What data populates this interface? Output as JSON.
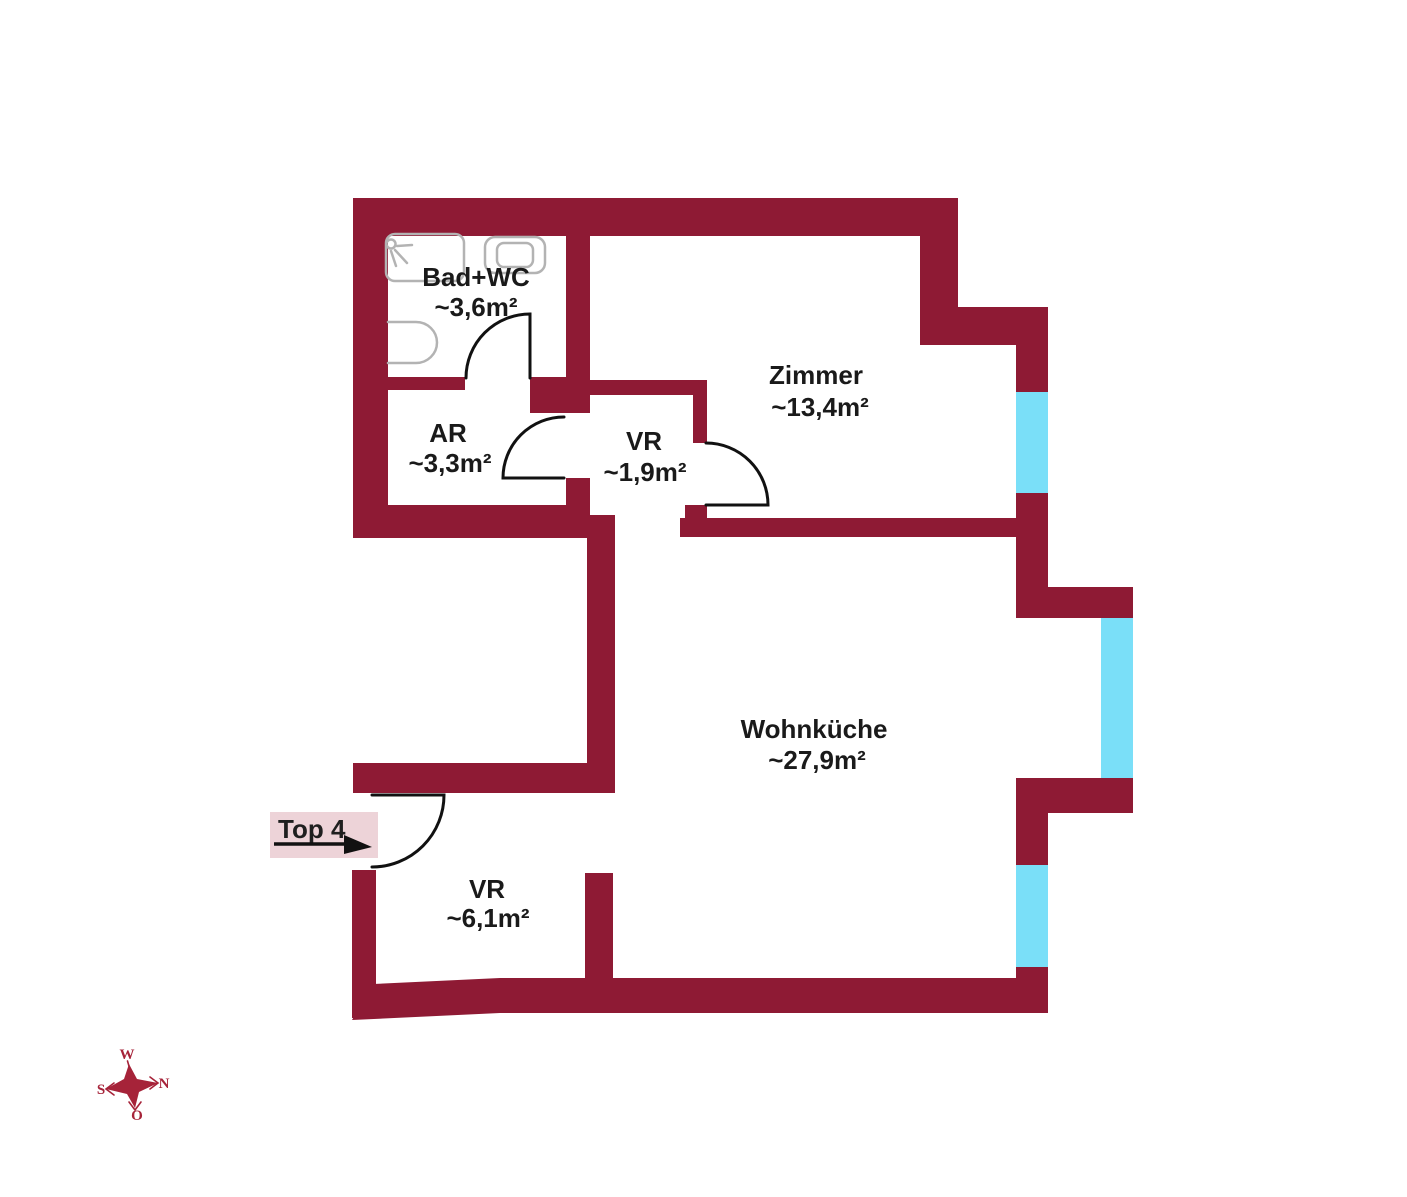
{
  "plan": {
    "unit": {
      "label": "Top 4"
    },
    "rooms": [
      {
        "id": "badwc",
        "name": "Bad+WC",
        "area": "~3,6m²"
      },
      {
        "id": "ar",
        "name": "AR",
        "area": "~3,3m²"
      },
      {
        "id": "vr-small",
        "name": "VR",
        "area": "~1,9m²"
      },
      {
        "id": "zimmer",
        "name": "Zimmer",
        "area": "~13,4m²"
      },
      {
        "id": "wohnkueche",
        "name": "Wohnküche",
        "area": "~27,9m²"
      },
      {
        "id": "vr-large",
        "name": "VR",
        "area": "~6,1m²"
      }
    ],
    "compass": {
      "top": "W",
      "right": "N",
      "left": "S",
      "bottom": "O"
    },
    "colors": {
      "wall": "#8E1A34",
      "window": "#7ADFF8",
      "unit_label_bg": "#EDD3D8",
      "compass": "#A62339",
      "text": "#1A1A1A"
    }
  }
}
